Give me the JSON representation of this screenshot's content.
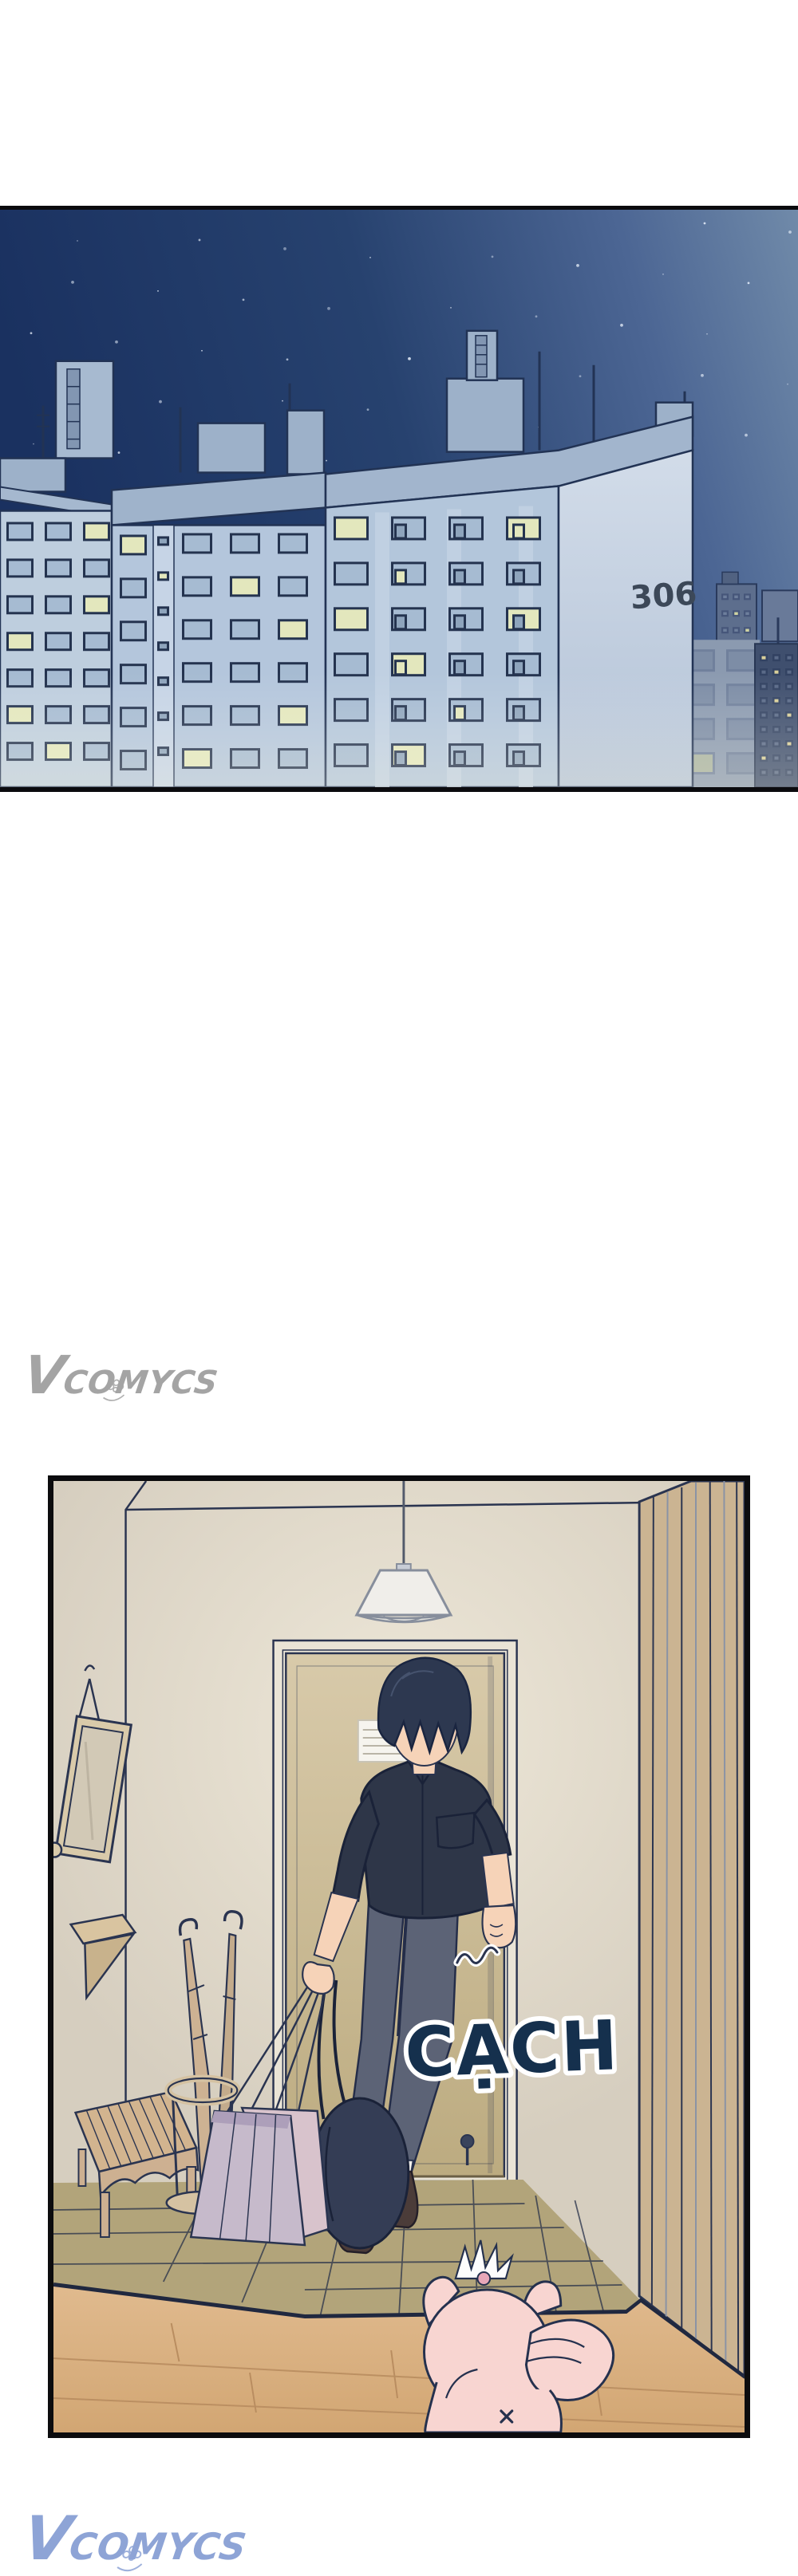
{
  "panel_city": {
    "description": "night cityscape of apartment blocks",
    "building_number": "306",
    "colors": {
      "sky_dark": "#1a3160",
      "sky_mid": "#27426f",
      "sky_light": "#708aa9",
      "outline": "#223354",
      "facade": "#b3c6db",
      "facade_light": "#cdd8e6",
      "roof": "#a2b5cd",
      "window_frame": "#24334f",
      "pane": "#a6bbd2",
      "pane_lit": "#e3e7bd",
      "tower_dark": "#3f4f6e",
      "number_color": "#3c4858"
    }
  },
  "panel_hallway": {
    "description": "entryway scene, man returning home with bags, pet waiting",
    "sfx": "CẠCH",
    "colors": {
      "wall": "#ddd5c6",
      "door": "#d4c6a6",
      "door_frame": "#eae4d6",
      "outline": "#2a3450",
      "tile_floor": "#b2a47a",
      "wood_floor": "#d9ae7e",
      "shirt": "#2e3648",
      "pants": "#5c6376",
      "skin": "#f6d3b8",
      "hair": "#2d3850",
      "bag": "#c6bacb",
      "duffel": "#343d55",
      "pig": "#f8d5d1",
      "slat_wall": "#cbb492",
      "bench": "#d2b48f",
      "sfx_color": "#15304d"
    }
  },
  "watermarks": {
    "middle": {
      "text": "VCOMYCS",
      "color": "#a4a4a4"
    },
    "bottom": {
      "text": "VCOMYCS",
      "color": "#8ea4d6"
    }
  }
}
